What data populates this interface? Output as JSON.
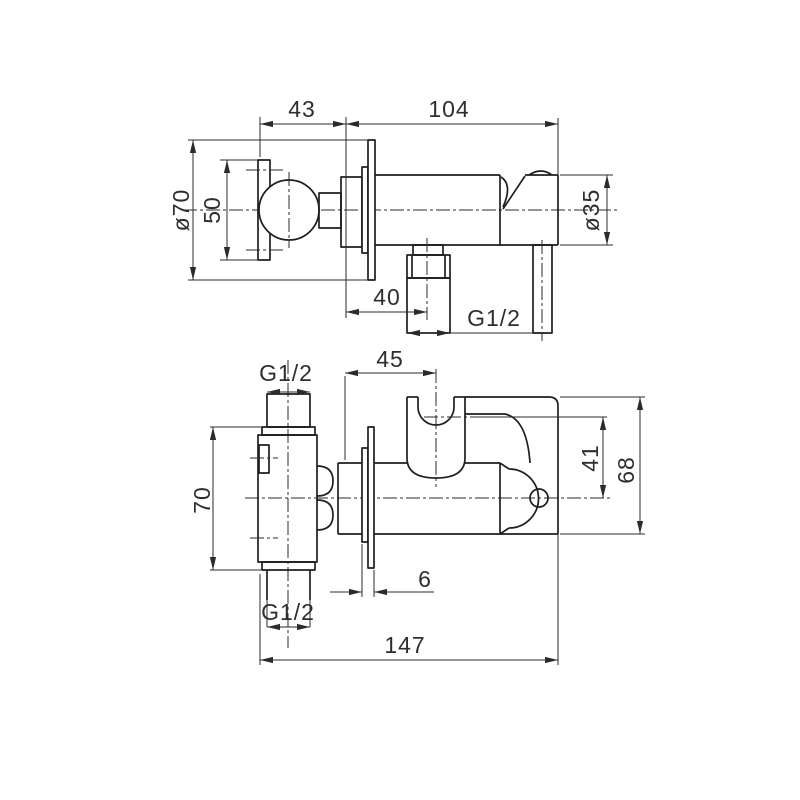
{
  "drawing": {
    "kind": "bidet-mixer-installation-dimensions",
    "views": {
      "top": "top-view",
      "front": "front-view"
    }
  },
  "dims": {
    "top_view": {
      "handle_to_wall": "43",
      "body_length": "104",
      "flange_diameter": "ø70",
      "handle_length": "50",
      "body_diameter": "ø35",
      "outlet_offset": "40",
      "outlet_thread": "G1/2"
    },
    "front_view": {
      "inlet_thread": "G1/2",
      "holder_offset": "45",
      "holder_center_height": "41",
      "lever_top_height": "68",
      "valve_body_height": "70",
      "outlet_thread": "G1/2",
      "flange_thickness": "6",
      "total_length": "147"
    }
  }
}
